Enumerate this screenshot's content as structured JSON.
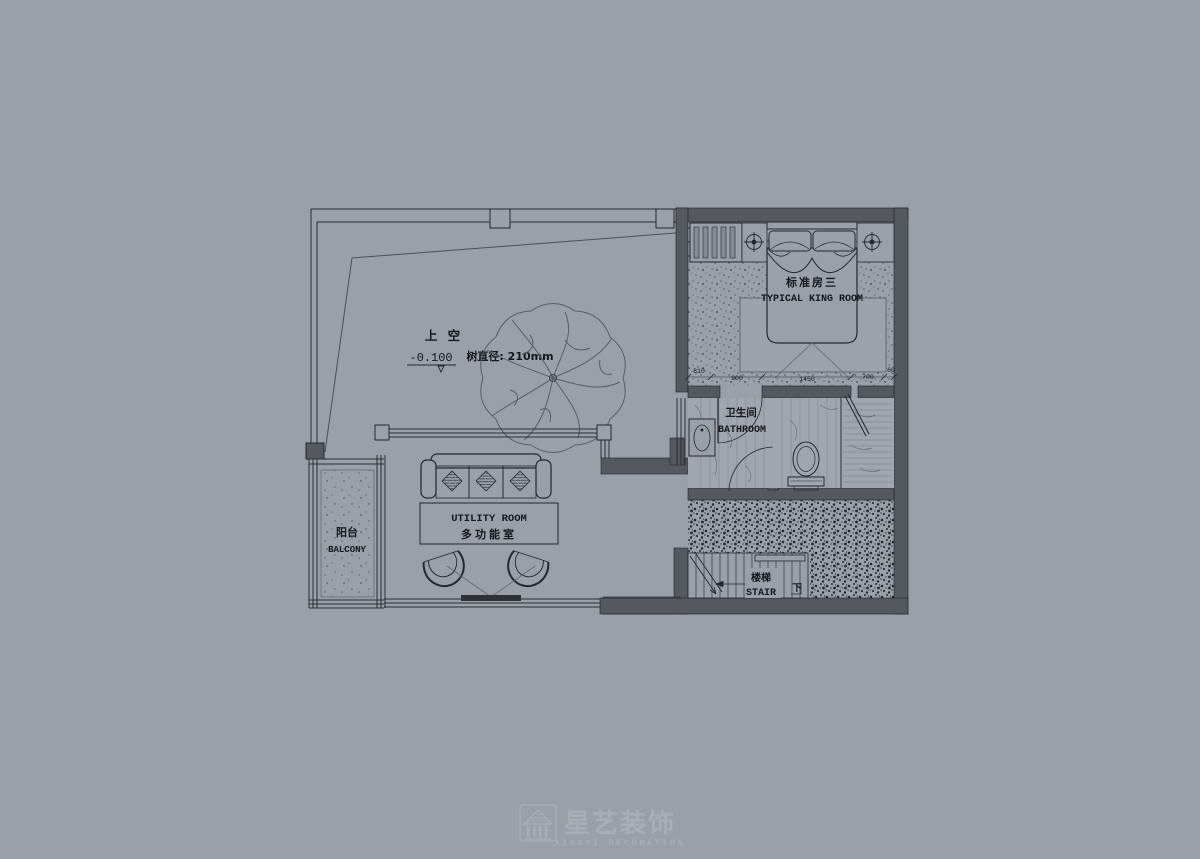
{
  "canvas": {
    "background": "#99a0a8",
    "line_dark": "#24272d",
    "wall_fill": "#54585f",
    "watermark_color": "#a9aeb5"
  },
  "plan": {
    "void": {
      "label": "上 空",
      "level": "-0.100"
    },
    "tree": {
      "diameter_label": "树直径: 210mm"
    },
    "king_room": {
      "name_cn": "标准房三",
      "name_en": "TYPICAL KING ROOM",
      "dimensions": [
        "810",
        "900",
        "1450",
        "700",
        "60"
      ]
    },
    "bathroom": {
      "name_cn": "卫生间",
      "name_en": "BATHROOM"
    },
    "balcony": {
      "name_cn": "阳台",
      "name_en": "BALCONY"
    },
    "utility_room": {
      "name_en": "UTILITY ROOM",
      "name_cn": "多功能室"
    },
    "stair": {
      "name_cn": "楼梯",
      "name_en": "STAIR",
      "direction": "下"
    }
  },
  "watermark": {
    "name_cn": "星艺装饰",
    "name_en": "XINGYI DECORATION"
  }
}
